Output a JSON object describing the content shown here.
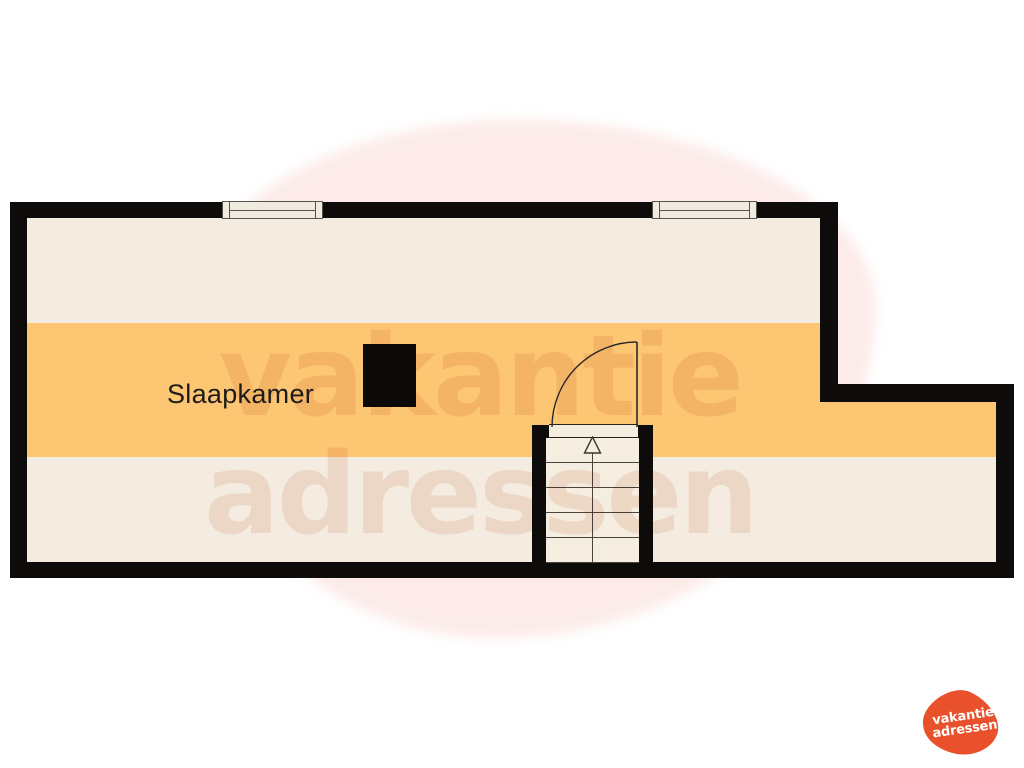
{
  "room": {
    "label": "Slaapkamer"
  },
  "watermark": {
    "line1": "vakantie",
    "line2": "adressen"
  },
  "logo": {
    "line1": "vakantie",
    "line2": "adressen"
  },
  "colors": {
    "wall_black": "#0e0c0a",
    "floor_cream": "#f4ece0",
    "accent_band_orange": "#fcc672",
    "watermark_pink": "#fcebe8",
    "logo_orange": "#e8512b"
  },
  "features": {
    "windows_count": 2,
    "staircase_direction": "up",
    "door_swing": "quarter-arc",
    "chimney_block": true
  }
}
